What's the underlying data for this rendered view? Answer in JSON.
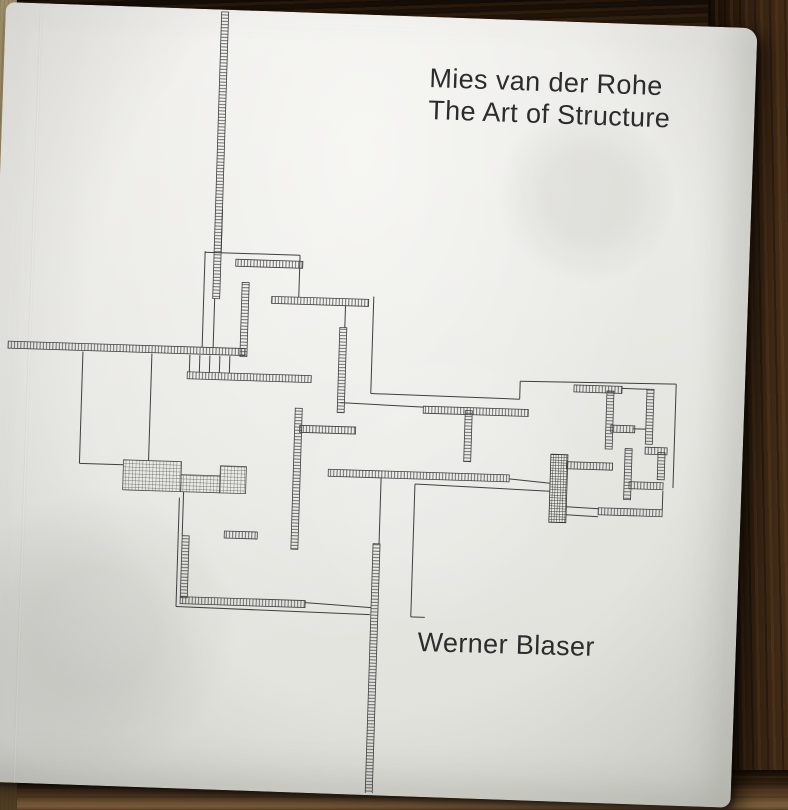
{
  "book_cover": {
    "title_line1": "Mies van der Rohe",
    "title_line2": "The Art of Structure",
    "author": "Werner Blaser",
    "colors": {
      "cover_paper": "#e9e9e5",
      "ink_text": "#2c2c2c",
      "plan_line": "#3f3f3f",
      "wood_dark": "#2e1d0d",
      "wood_light": "#a48c60"
    }
  },
  "floor_plan": {
    "line_color": "#3f3f3f",
    "wall_thickness": 7,
    "walls_h": [
      [
        233,
        255,
        67
      ],
      [
        270,
        291,
        97
      ],
      [
        8,
        344,
        237
      ],
      [
        188,
        369,
        124
      ],
      [
        425,
        396,
        105
      ],
      [
        302,
        419,
        56
      ],
      [
        332,
        462,
        181
      ],
      [
        230,
        527,
        33
      ],
      [
        188,
        594,
        125
      ],
      [
        575,
        370,
        48
      ],
      [
        613,
        409,
        24
      ],
      [
        648,
        430,
        22
      ],
      [
        570,
        447,
        46
      ],
      [
        633,
        465,
        34
      ],
      [
        603,
        492,
        64
      ]
    ],
    "walls_v": [
      [
        211,
        8,
        287
      ],
      [
        240,
        278,
        74
      ],
      [
        339,
        320,
        85
      ],
      [
        467,
        399,
        51
      ],
      [
        297,
        402,
        141
      ],
      [
        188,
        533,
        62
      ],
      [
        379,
        535,
        255
      ],
      [
        608,
        375,
        58
      ],
      [
        648,
        372,
        55
      ],
      [
        661,
        435,
        27
      ],
      [
        628,
        432,
        51
      ]
    ],
    "hatch_blocks": [
      [
        127,
        459,
        58,
        30
      ],
      [
        185,
        472,
        39,
        17
      ],
      [
        224,
        462,
        26,
        27
      ]
    ],
    "solid_blocks": [
      [
        554,
        440,
        17,
        68
      ]
    ],
    "thin_lines": [
      [
        202,
        248,
        202,
        344
      ],
      [
        202,
        249,
        297,
        249
      ],
      [
        297,
        249,
        297,
        291
      ],
      [
        218,
        205,
        218,
        249
      ],
      [
        213,
        295,
        213,
        344
      ],
      [
        190,
        352,
        190,
        369
      ],
      [
        200,
        352,
        200,
        369
      ],
      [
        210,
        352,
        210,
        369
      ],
      [
        220,
        352,
        220,
        369
      ],
      [
        230,
        352,
        230,
        369
      ],
      [
        83,
        352,
        83,
        464
      ],
      [
        83,
        464,
        127,
        464
      ],
      [
        152,
        352,
        152,
        459
      ],
      [
        344,
        298,
        344,
        320
      ],
      [
        372,
        288,
        372,
        385
      ],
      [
        372,
        385,
        521,
        386
      ],
      [
        521,
        386,
        521,
        368
      ],
      [
        521,
        368,
        677,
        366
      ],
      [
        677,
        366,
        677,
        470
      ],
      [
        623,
        372,
        648,
        372
      ],
      [
        342,
        395,
        425,
        397
      ],
      [
        188,
        489,
        188,
        533
      ],
      [
        184,
        495,
        184,
        604
      ],
      [
        184,
        604,
        378,
        606
      ],
      [
        313,
        596,
        379,
        599
      ],
      [
        385,
        469,
        385,
        535
      ],
      [
        419,
        474,
        419,
        607
      ],
      [
        419,
        474,
        554,
        477
      ],
      [
        419,
        607,
        433,
        607
      ],
      [
        513,
        466,
        554,
        469
      ],
      [
        571,
        492,
        603,
        493
      ],
      [
        571,
        500,
        603,
        501
      ],
      [
        667,
        473,
        667,
        492
      ],
      [
        635,
        412,
        648,
        412
      ]
    ]
  }
}
